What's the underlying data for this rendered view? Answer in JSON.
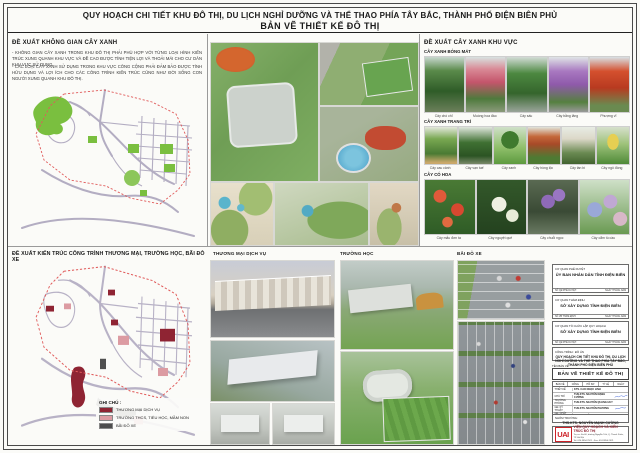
{
  "page": {
    "title": "QUY HOẠCH CHI TIẾT KHU ĐÔ THỊ, DU LỊCH NGHỈ DƯỠNG VÀ THỂ THAO PHÍA TÂY BẮC, THÀNH PHỐ ĐIỆN BIÊN PHỦ",
    "subtitle": "BẢN VẼ THIẾT KẾ ĐÔ THỊ"
  },
  "green_space": {
    "heading": "ĐỀ XUẤT KHÔNG GIAN CÂY XANH",
    "para1": "- KHÔNG GIAN CÂY XANH TRONG KHU ĐÔ THỊ PHẢI PHÙ HỢP VỚI TỪNG LOẠI HÌNH KIẾN TRÚC XUNG QUANH KHU VỰC VÀ ĐỀ CAO ĐƯỢC TÍNH TIỆN LỢI VÀ THOẢI MÁI CHO CƯ DÂN KHU VỰC SỬ DỤNG.",
    "para2": "- CÁC LOẠI CÂY XANH SỬ DỤNG TRONG KHU VỰC CÔNG CỘNG PHẢI ĐẢM BẢO ĐƯỢC TÍNH HỮU DỤNG VÀ LỢI ÍCH CHO CÁC CÔNG TRÌNH KIẾN TRÚC CŨNG NHƯ ĐỜI SỐNG CON NGƯỜI XUNG QUANH KHU ĐÔ THỊ."
  },
  "trees": {
    "heading": "ĐỀ XUẤT CÂY XANH KHU VỰC",
    "group1": {
      "title": "CÂY XANH BÓNG MÁT",
      "items": [
        "Cây chò chỉ",
        "Muồng hoa đào",
        "Cây sấu",
        "Cây bằng lăng",
        "Phượng vĩ"
      ]
    },
    "group2": {
      "title": "CÂY XANH TRANG TRÍ",
      "items": [
        "Cây cau cảnh",
        "Cây vạn tuế",
        "Cây xanh",
        "Cây hồng lộc",
        "Cây tần bì",
        "Cây ngô đồng"
      ]
    },
    "group3": {
      "title": "CÂY CÓ HOA",
      "items": [
        "Cây mẫu đơn ta",
        "Cây nguyệt quế",
        "Cây chuỗi ngọc",
        "Cây cẩm tú cầu"
      ]
    }
  },
  "architecture": {
    "heading": "ĐỀ XUẤT KIẾN TRÚC CÔNG TRÌNH THƯƠNG MẠI, TRƯỜNG HỌC, BÃI ĐỖ XE",
    "columns": {
      "commercial": "THƯƠNG MẠI DỊCH VỤ",
      "school": "TRƯỜNG HỌC",
      "parking": "BÃI ĐỖ XE"
    },
    "legend": {
      "title": "GHI CHÚ :",
      "items": [
        {
          "label": "THƯƠNG MẠI DỊCH VỤ",
          "color": "#8f2433"
        },
        {
          "label": "TRƯỜNG THCS, TIỂU HỌC, MẦM NON",
          "color": "#dc9ba2"
        },
        {
          "label": "BÃI ĐỖ XE",
          "color": "#4d4d4d"
        }
      ]
    }
  },
  "title_block": {
    "approve": {
      "label": "CƠ QUAN PHÊ DUYỆT",
      "name": "ỦY BAN NHÂN DÂN TỈNH ĐIỆN BIÊN",
      "note_left": "SỐ QĐ PHÊ DUYỆT:",
      "note_right": "NGÀY      THÁNG      NĂM"
    },
    "appraise": {
      "label": "CƠ QUAN THẨM ĐỊNH",
      "name": "SỞ XÂY DỰNG TỈNH ĐIỆN BIÊN",
      "note_left": "SỐ VB THẨM ĐỊNH:",
      "note_right": "NGÀY      THÁNG      NĂM"
    },
    "organize": {
      "label": "CƠ QUAN TỔ CHỨC LẬP QUY HOẠCH",
      "name": "SỞ XÂY DỰNG TỈNH ĐIỆN BIÊN",
      "note_left": "SỐ QĐ PHÊ DUYỆT:",
      "note_right": "NGÀY      THÁNG      NĂM"
    },
    "project_label": "CÔNG TRÌNH : ĐỒ ÁN",
    "project_name": "QUY HOẠCH CHI TIẾT KHU ĐÔ THỊ, DU LỊCH NGHỈ DƯỠNG VÀ THỂ THAO PHÍA TÂY BẮC, THÀNH PHỐ ĐIỆN BIÊN PHỦ",
    "drawing_label": "TÊN BẢN VẼ",
    "drawing_name": "BẢN VẼ THIẾT KẾ ĐÔ THỊ",
    "meta_header": [
      "BẢN VẼ",
      "CÔNG ĐOẠN",
      "HỒ SƠ",
      "TỶ LỆ",
      "NGÀY"
    ],
    "rows": [
      {
        "role": "THIẾT KẾ",
        "person": "KTS. CAO NGỌC LINH"
      },
      {
        "role": "CHỦ TRÌ",
        "person": "THS.KTS. NGUYỄN MẠNH CƯỜNG"
      },
      {
        "role": "TRƯỞNG PHÒNG",
        "person": "THS.KTS. NGUYỄN QUANG HUY"
      },
      {
        "role": "GĐ. KỸ THUẬT",
        "person": "THS.KTS. NGUYỄN PHƯƠNG"
      },
      {
        "role": "GĐ. CHẤT LƯỢNG",
        "person": "THS.KTS. VŨ DUY NAM"
      }
    ],
    "leader_label": "NHÓM TRƯỞNG:",
    "leader_name": "THS.KTS. NGUYỄN MẠNH CƯỜNG",
    "logo_text": "UAI",
    "org_name": "VIỆN QUY HOẠCH VÀ KIẾN TRÚC ĐÔ THỊ",
    "org_line1": "Trụ sở: Km10, đường Nguyễn Trãi, Q. Thanh Xuân, TP. Hà Nội",
    "org_line2": "Tel: 024.3854.2521  -  Fax: 024.3854.2521"
  },
  "palette": {
    "accent_red": "#8f2433",
    "school_pink": "#dc9ba2",
    "parking_gray": "#4d4d4d",
    "map_green": "#7abf3f",
    "logo_red": "#cc2127"
  }
}
